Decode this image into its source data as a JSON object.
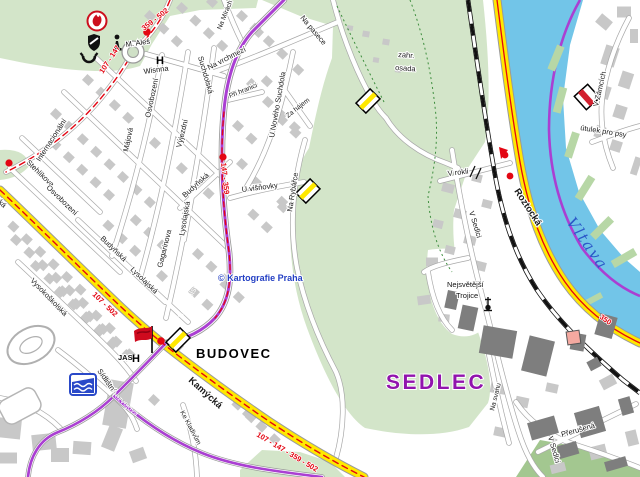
{
  "districts": {
    "budovec": "BUDOVEC",
    "sedlec": "SEDLEC"
  },
  "water": {
    "vltava": "Vltava"
  },
  "copyright": "© Kartografie Praha",
  "areas": {
    "zahr1": "zahr.",
    "zahr2": "osada"
  },
  "poi": {
    "m_ales": "M. Aleš",
    "wisnna": "Wisnna",
    "jas": "JAS",
    "hotel_glyph": "H",
    "utulek": "útulek pro psy",
    "trojice1": "Nejsvětější",
    "trojice2": "Trojice"
  },
  "routes": {
    "r107_147": "107 - 147",
    "r359_502": "359 - 502",
    "r147_359": "147 - 359",
    "r107_502": "107 - 502",
    "r_combined": "107 - 147 - 359 - 502",
    "r350": "350"
  },
  "streets": {
    "internacionalni": "Internacionální",
    "stehlikova": "Stehlíkova",
    "osvobozeni": "Osvobození",
    "osvobozeni2": "Osvobození",
    "majova": "Májová",
    "vyjezdni": "Výjezdní",
    "budynska": "Budyňská",
    "budynska2": "Budyňská",
    "lysolajska": "Lysolajská",
    "lysolajska2": "Lysolajská",
    "gagarinova": "Gagarinova",
    "vysokoskolska": "Vysokoškolská",
    "sidlistni": "Sídlištní",
    "rozvojova": "Rozvojová",
    "ke_kladivum": "Ke Kladivům",
    "kamycka": "Kamýcká",
    "kamycka2": "Kamýcká",
    "suchdolska": "Suchdolská",
    "suchdolska_white": "Suchdolská",
    "na_mirach": "Na Mírách",
    "na_vrchmezi": "Na vrchmezí",
    "na_pasece": "Na pasece",
    "u_noveho_suchdola": "U Nového Suchdola",
    "za_hajem": "Za hájem",
    "pri_hranici": "Při hranici",
    "u_visnovky": "U višňovky",
    "na_rybarce": "Na Rybářce",
    "roztocka": "Roztocká",
    "v_rokli": "V rokli",
    "v_sedlci": "V Sedlci",
    "v_sedlci2": "V Sedlci",
    "na_svahu": "Na svahu",
    "prerusena": "Přerušená",
    "v_zamcich": "V Zámcích"
  },
  "icons": {
    "fire_station": "flame-in-circle",
    "heraldic": "black-shield",
    "monument": "statue",
    "post": "post-horn",
    "hotel": "letter-H",
    "swimming_pool": "pool-waves",
    "church": "cross-with-dot",
    "destination_flag": "red-flag",
    "bus_stop": "red-dot",
    "marker_yellow": "yellow-striped-parallelogram",
    "marker_red": "red-striped-square",
    "building_highlight": "pink-square"
  },
  "colors": {
    "river": "#72c5e8",
    "road_major": "#ffe800",
    "route_red": "#e30613",
    "purple_road": "#aa3fd2",
    "green": "#d3e5c9",
    "green_dark": "#a3c790",
    "building": "#c8c8c8",
    "building_dark": "#7e7e7e",
    "sedlec_label": "#9113ad",
    "vltava_label": "#2b58c8",
    "copyright_blue": "#2440c4"
  }
}
